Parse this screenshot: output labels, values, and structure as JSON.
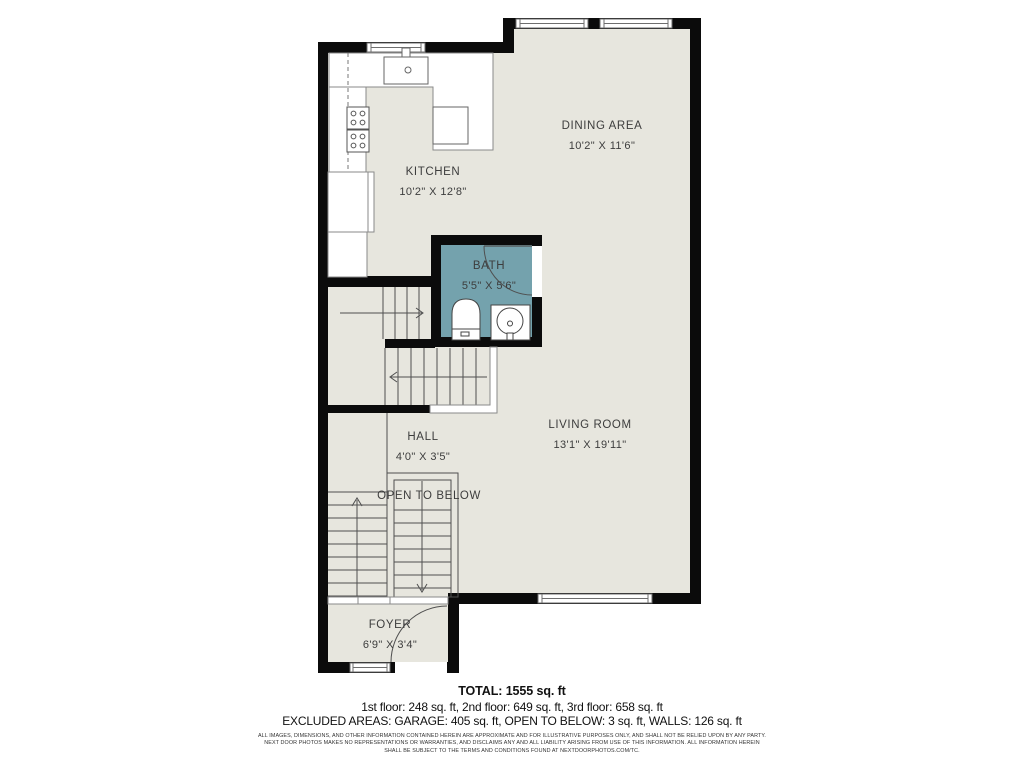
{
  "plan": {
    "rooms": [
      {
        "id": "dining",
        "name": "DINING AREA",
        "dims": "10'2\" X 11'6\""
      },
      {
        "id": "kitchen",
        "name": "KITCHEN",
        "dims": "10'2\" X 12'8\""
      },
      {
        "id": "bath",
        "name": "BATH",
        "dims": "5'5\" X 5'6\""
      },
      {
        "id": "living",
        "name": "LIVING ROOM",
        "dims": "13'1\" X 19'11\""
      },
      {
        "id": "hall",
        "name": "HALL",
        "dims": "4'0\" X 3'5\""
      },
      {
        "id": "foyer",
        "name": "FOYER",
        "dims": "6'9\" X 3'4\""
      }
    ],
    "annotations": {
      "open_to_below": "OPEN TO BELOW"
    },
    "colors": {
      "wall": "#0b0b0b",
      "floor": "#e7e6de",
      "bath_floor": "#74a2ad",
      "line": "#4f4f4f",
      "label_text": "#3d3d3d"
    }
  },
  "footer": {
    "total": "TOTAL: 1555 sq. ft",
    "floors": "1st floor: 248 sq. ft, 2nd floor: 649 sq. ft, 3rd floor: 658 sq. ft",
    "excluded": "EXCLUDED AREAS: GARAGE: 405 sq. ft, OPEN TO BELOW: 3 sq. ft, WALLS: 126 sq. ft",
    "disclaimer_lines": [
      "ALL IMAGES, DIMENSIONS, AND OTHER INFORMATION CONTAINED HEREIN ARE APPROXIMATE AND FOR ILLUSTRATIVE PURPOSES ONLY, AND SHALL NOT BE RELIED UPON BY ANY PARTY.",
      "NEXT DOOR PHOTOS MAKES NO REPRESENTATIONS OR WARRANTIES, AND DISCLAIMS ANY AND ALL LIABILITY ARISING FROM USE OF THIS INFORMATION. ALL INFORMATION HEREIN",
      "SHALL BE SUBJECT TO THE TERMS AND CONDITIONS FOUND AT NEXTDOORPHOTOS.COM/TC."
    ]
  }
}
